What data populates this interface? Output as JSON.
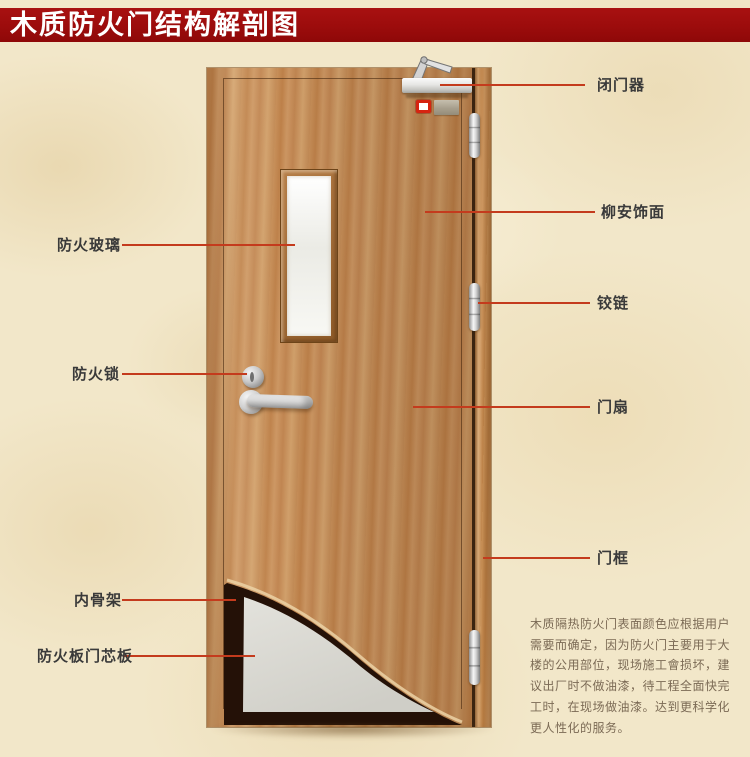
{
  "title": "木质防火门结构解剖图",
  "colors": {
    "banner_red": "#9c0c0c",
    "callout_line": "#c43b1d",
    "label_text": "#3a3a3a",
    "paragraph_text": "#7b6a55",
    "door_wood": "#c68e58",
    "core_gray": "#d8d7d1",
    "skeleton_dark": "#241107"
  },
  "callouts": {
    "left": [
      {
        "id": "fire-glass",
        "text": "防火玻璃"
      },
      {
        "id": "fire-lock",
        "text": "防火锁"
      },
      {
        "id": "inner-skeleton",
        "text": "内骨架"
      },
      {
        "id": "core-board",
        "text": "防火板门芯板"
      }
    ],
    "right": [
      {
        "id": "door-closer",
        "text": "闭门器"
      },
      {
        "id": "lauan-veneer",
        "text": "柳安饰面"
      },
      {
        "id": "hinge",
        "text": "铰链"
      },
      {
        "id": "door-leaf",
        "text": "门扇"
      },
      {
        "id": "door-frame",
        "text": "门框"
      }
    ]
  },
  "description": "木质隔热防火门表面颜色应根据用户\n需要而确定，因为防火门主要用于大\n楼的公用部位，现场施工會损坏，建\n议出厂时不做油漆，待工程全面快完\n工时，在现场做油漆。达到更科学化\n更人性化的服务。"
}
